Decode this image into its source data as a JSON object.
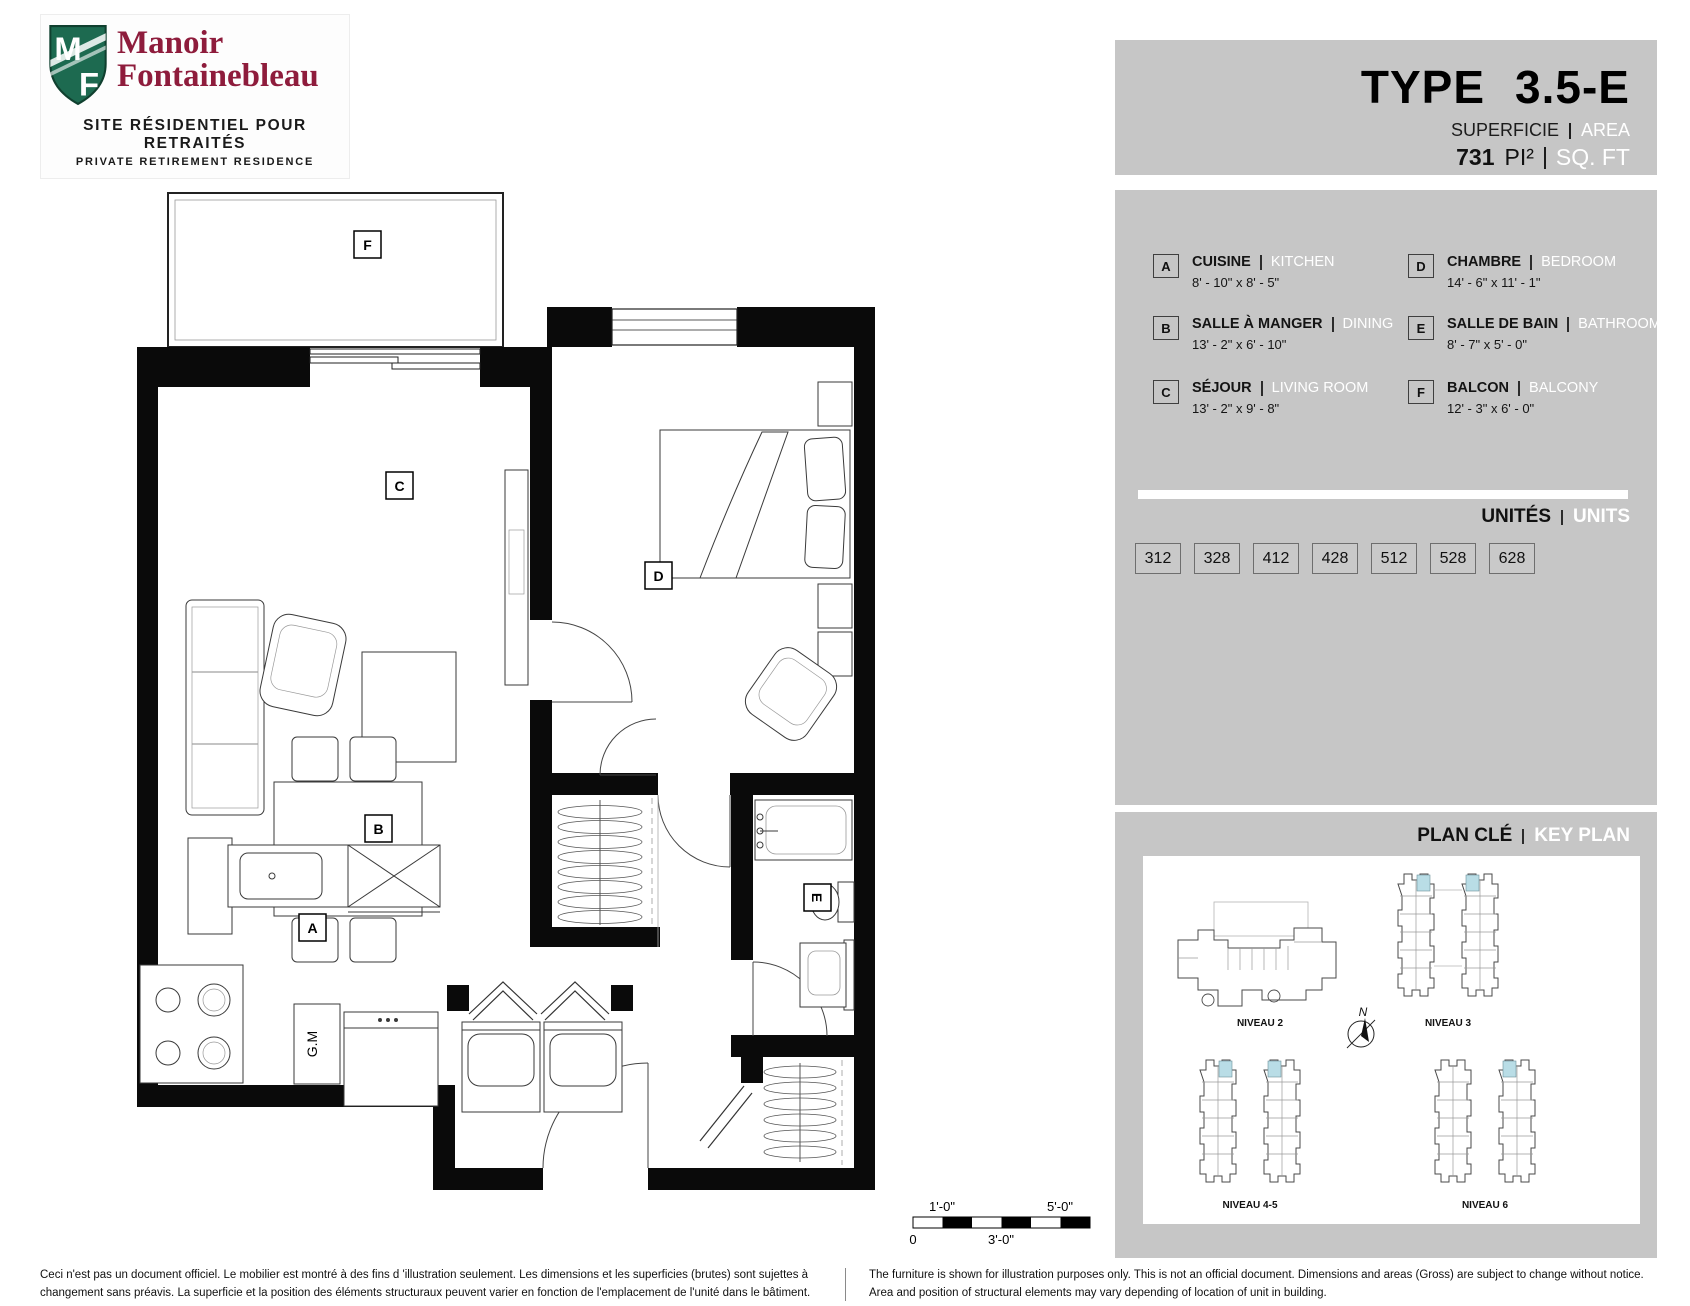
{
  "logo": {
    "monogram": "MF",
    "name_line1": "Manoir",
    "name_line2": "Fontainebleau",
    "tagline_fr": "SITE RÉSIDENTIEL POUR RETRAITÉS",
    "tagline_en": "PRIVATE RETIREMENT RESIDENCE",
    "shield_color": "#1d6a50",
    "name_color": "#8e1c3c"
  },
  "header": {
    "type_label": "TYPE",
    "type_value": "3.5-E",
    "superficie_label": "SUPERFICIE",
    "area_label": "AREA",
    "area_value": "731",
    "area_unit_fr": "PI²",
    "area_unit_en": "SQ. FT"
  },
  "legend": {
    "rooms": [
      {
        "letter": "A",
        "name_fr": "CUISINE",
        "name_en": "KITCHEN",
        "dimensions": "8' - 10\" x 8' - 5\""
      },
      {
        "letter": "B",
        "name_fr": "SALLE À MANGER",
        "name_en": "DINING",
        "dimensions": "13' - 2\" x 6' - 10\""
      },
      {
        "letter": "C",
        "name_fr": "SÉJOUR",
        "name_en": "LIVING ROOM",
        "dimensions": "13' - 2\" x 9' - 8\""
      },
      {
        "letter": "D",
        "name_fr": "CHAMBRE",
        "name_en": "BEDROOM",
        "dimensions": "14' - 6\" x 11' - 1\""
      },
      {
        "letter": "E",
        "name_fr": "SALLE DE BAIN",
        "name_en": "BATHROOM",
        "dimensions": "8' - 7\" x 5' - 0\""
      },
      {
        "letter": "F",
        "name_fr": "BALCON",
        "name_en": "BALCONY",
        "dimensions": "12' - 3\" x 6' - 0\""
      }
    ],
    "units_label_fr": "UNITÉS",
    "units_label_en": "UNITS",
    "units": [
      "312",
      "328",
      "412",
      "428",
      "512",
      "528",
      "628"
    ]
  },
  "key_plan": {
    "title_fr": "PLAN CLÉ",
    "title_en": "KEY PLAN",
    "levels": [
      "NIVEAU 2",
      "NIVEAU 3",
      "NIVEAU 4-5",
      "NIVEAU 6"
    ],
    "compass_label": "N",
    "highlight_color": "#b9dde6"
  },
  "floor_plan": {
    "room_letters": {
      "a": "A",
      "b": "B",
      "c": "C",
      "d": "D",
      "e": "E",
      "f": "F"
    },
    "gm_label": "G.M",
    "scale_bar": {
      "top_left": "1'-0\"",
      "top_right": "5'-0\"",
      "bottom_left": "0",
      "bottom_mid": "3'-0\""
    }
  },
  "disclaimer": {
    "fr_line1": "Ceci n'est pas un document officiel.  Le mobilier est montré à des fins d 'illustration seulement.  Les dimensions et les superficies (brutes) sont sujettes à",
    "fr_line2": "changement sans préavis. La superficie et la position des éléments structuraux peuvent varier en fonction de l'emplacement de l'unité dans le bâtiment.",
    "en_line1": "The furniture is shown for illustration purposes only.  This is not an official document.  Dimensions and areas (Gross) are subject to change without notice.",
    "en_line2": "Area and position of structural elements may vary depending of location of unit in building."
  }
}
